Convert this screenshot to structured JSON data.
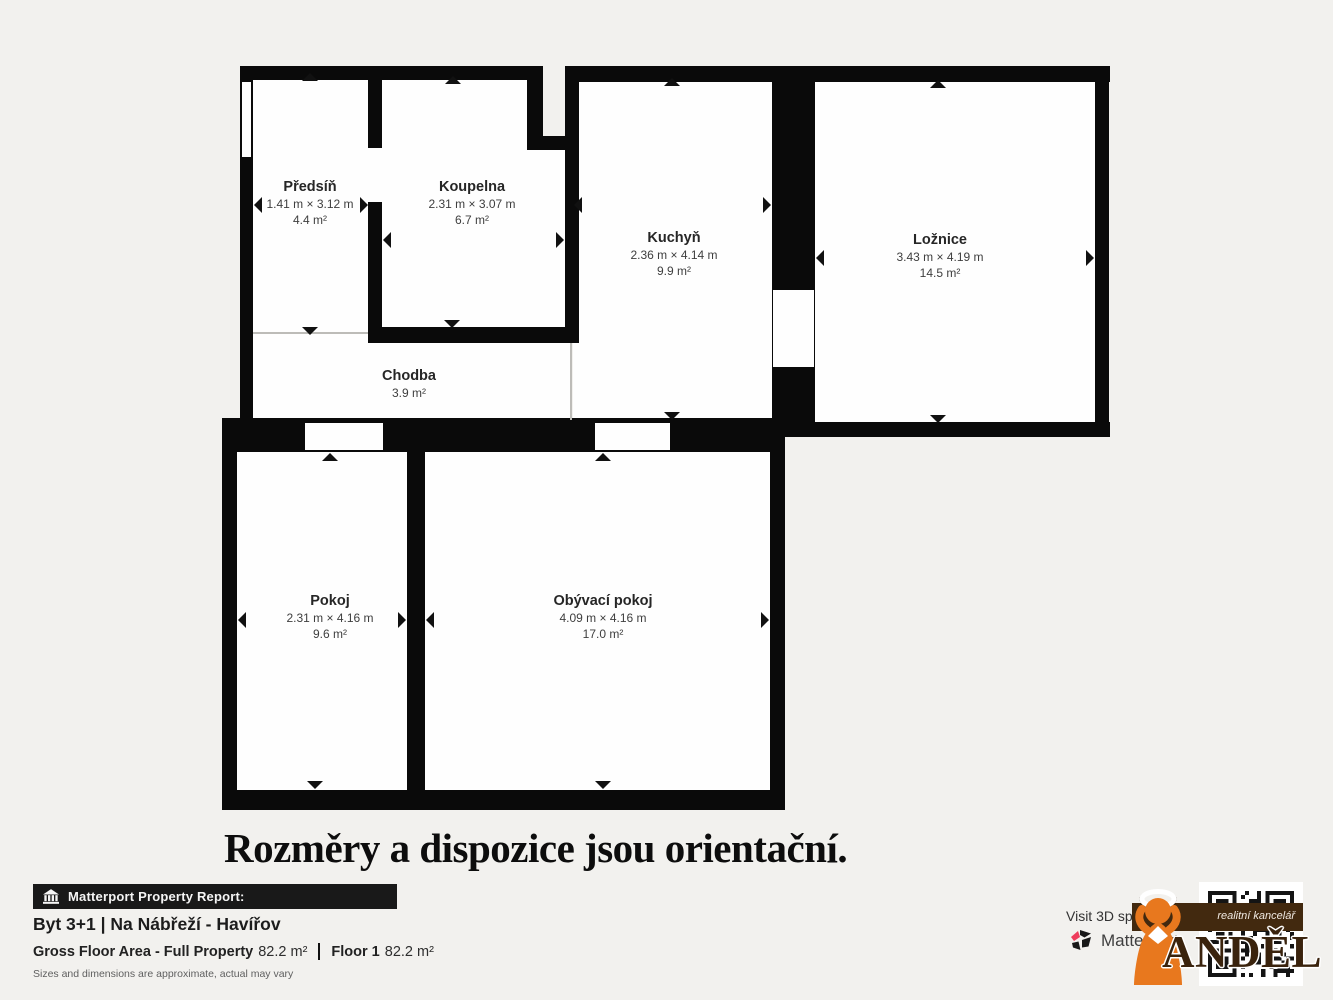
{
  "colors": {
    "background": "#f2f1ee",
    "wall": "#0a0a0a",
    "room_fill": "#fefefe",
    "banner_background": "#191919",
    "matterport_pink": "#ee3d5c",
    "angel_orange": "#e8781e",
    "logo_brown": "#42290f"
  },
  "plan": {
    "rooms": [
      {
        "name": "Předsíň",
        "dims": "1.41 m × 3.12 m",
        "area": "4.4 m²"
      },
      {
        "name": "Koupelna",
        "dims": "2.31 m × 3.07 m",
        "area": "6.7 m²"
      },
      {
        "name": "Kuchyň",
        "dims": "2.36 m × 4.14 m",
        "area": "9.9 m²"
      },
      {
        "name": "Ložnice",
        "dims": "3.43 m × 4.19 m",
        "area": "14.5 m²"
      },
      {
        "name": "Chodba",
        "area": "3.9 m²"
      },
      {
        "name": "Pokoj",
        "dims": "2.31 m × 4.16 m",
        "area": "9.6 m²"
      },
      {
        "name": "Obývací pokoj",
        "dims": "4.09 m × 4.16 m",
        "area": "17.0 m²"
      }
    ],
    "disclaimer": "Rozměry a dispozice jsou orientační."
  },
  "footer": {
    "report_banner": "Matterport Property Report:",
    "property_title": "Byt 3+1 | Na Nábřeží - Havířov",
    "gross_floor_area_label": "Gross Floor Area - Full Property",
    "gross_floor_area_value": "82.2 m²",
    "floor_label": "Floor 1",
    "floor_value": "82.2 m²",
    "note": "Sizes and dimensions are approximate, actual may vary",
    "visit_text": "Visit 3D sp",
    "matterport_wordmark": "Matterport"
  },
  "agency_logo": {
    "brand": "ANDĚL",
    "tagline": "realitní kancelář"
  }
}
